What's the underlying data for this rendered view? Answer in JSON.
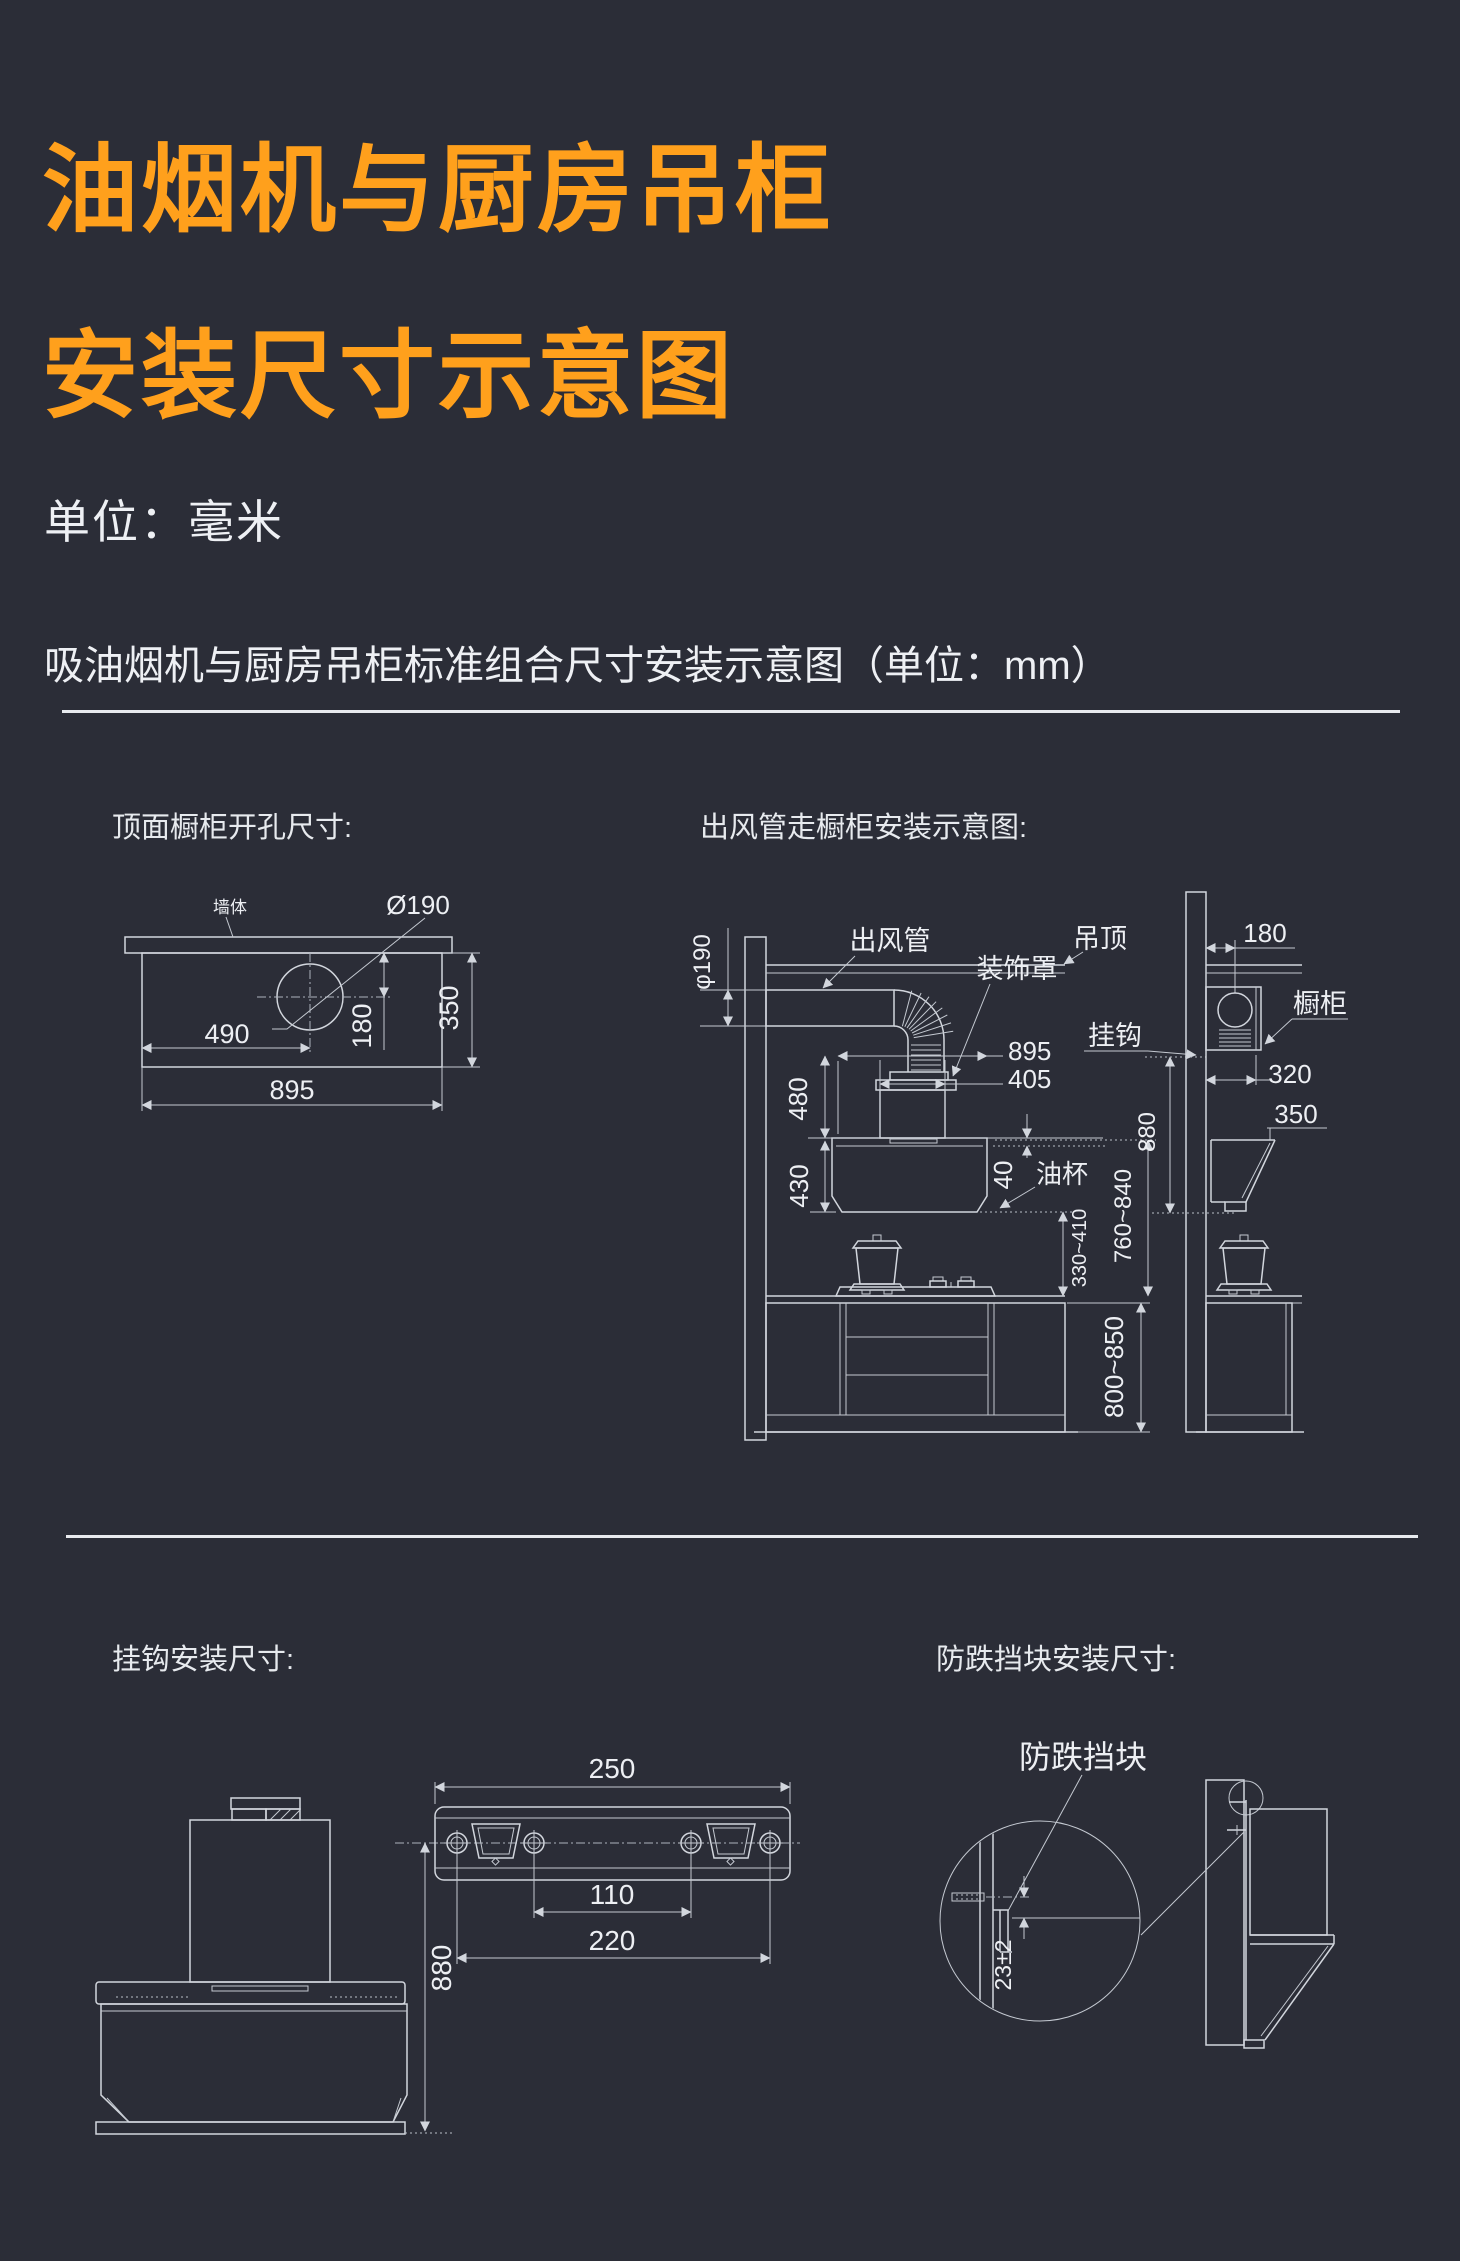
{
  "page": {
    "bg": "#2b2d37",
    "accent": "#ffa01c",
    "line_color": "#d2d6dd"
  },
  "header": {
    "title_line1": "油烟机与厨房吊柜",
    "title_line2": "安装尺寸示意图",
    "unit_note": "单位：毫米",
    "section_title": "吸油烟机与厨房吊柜标准组合尺寸安装示意图（单位：mm）"
  },
  "top_view": {
    "heading": "顶面橱柜开孔尺寸:",
    "labels": {
      "wall": "墙体",
      "hole_dia": "Ø190"
    },
    "dims": {
      "hole_offset_x": "490",
      "hole_center_to_wall": "180",
      "depth": "350",
      "width": "895"
    }
  },
  "duct_view": {
    "heading": "出风管走橱柜安装示意图:",
    "labels": {
      "duct": "出风管",
      "cover": "装饰罩",
      "ceiling": "吊顶",
      "hook": "挂钩",
      "cabinet": "橱柜",
      "oil_cup": "油杯"
    },
    "dims": {
      "duct_dia": "φ190",
      "wall_clearance": "180",
      "hood_width": "895",
      "cover_width": "405",
      "cover_height": "480",
      "hood_height": "430",
      "oil_cup_gap": "40",
      "hook_height": "880",
      "cabinet_depth": "320",
      "hood_depth": "350",
      "hood_to_counter": "330~410",
      "hood_top_to_counter": "760~840",
      "counter_height": "800~850"
    }
  },
  "hook_view": {
    "heading": "挂钩安装尺寸:",
    "dims": {
      "bracket_width": "250",
      "inner_hole_spacing": "110",
      "outer_hole_spacing": "220",
      "hook_height": "880"
    }
  },
  "block_view": {
    "heading": "防跌挡块安装尺寸:",
    "labels": {
      "block": "防跌挡块"
    },
    "dims": {
      "offset": "23±2"
    }
  }
}
